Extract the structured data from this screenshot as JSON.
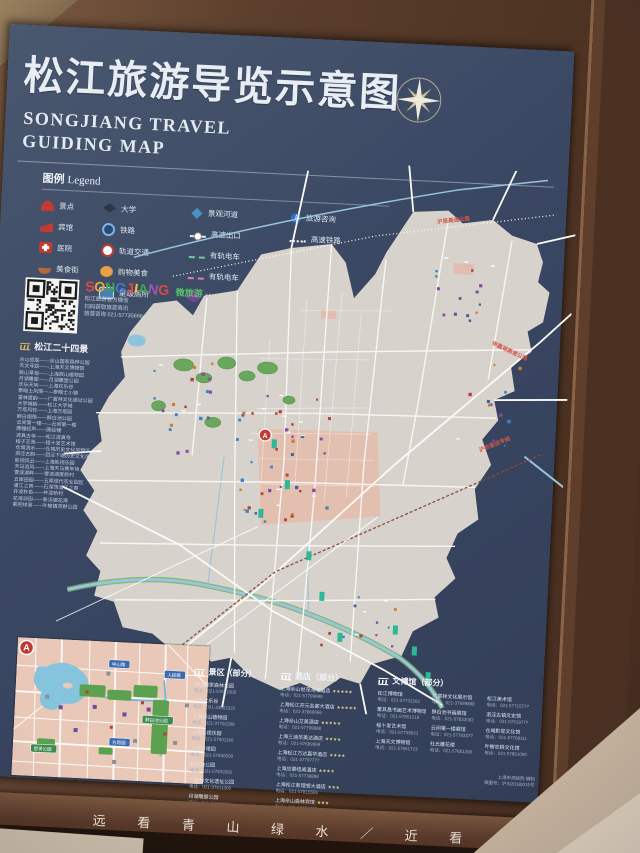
{
  "title": {
    "cn": "松江旅游导览示意图",
    "en_line1": "SONGJIANG TRAVEL",
    "en_line2": "GUIDING MAP"
  },
  "legend": {
    "heading_cn": "图例",
    "heading_en": "Legend",
    "columns": [
      {
        "items": [
          {
            "icon": "scenic",
            "label": "景点"
          },
          {
            "icon": "hotel",
            "label": "宾馆"
          },
          {
            "icon": "hospital",
            "label": "医院"
          },
          {
            "icon": "food",
            "label": "美食街"
          },
          {
            "icon": "greenway",
            "label": "绿道"
          }
        ]
      },
      {
        "items": [
          {
            "icon": "university",
            "label": "大学"
          },
          {
            "icon": "railway",
            "label": "铁路"
          },
          {
            "icon": "metro",
            "label": "轨道交通"
          },
          {
            "icon": "shopping",
            "label": "购物美食"
          },
          {
            "icon": "toilet",
            "label": "星级厕所"
          }
        ]
      },
      {
        "items": [
          {
            "icon": "river",
            "label": "景观河道"
          },
          {
            "icon": "exit",
            "label": "高速出口"
          },
          {
            "icon": "tram-green",
            "label": "有轨电车"
          },
          {
            "icon": "tram-pink",
            "label": "有轨电车"
          },
          {
            "icon": "culture",
            "label": "旅游文创"
          }
        ]
      },
      {
        "items": [
          {
            "icon": "info",
            "label": "旅游咨询"
          },
          {
            "icon": "hsr",
            "label": "高速铁路"
          }
        ]
      }
    ]
  },
  "qr": {
    "logo": "SONGJIANG",
    "logo_colors": [
      "#e2483d",
      "#f0a32f",
      "#3fa457",
      "#3a7bd5",
      "#e2483d",
      "#f0c03f",
      "#3fa457",
      "#9b59b6",
      "#e2483d"
    ],
    "logo_suffix": "微旅游",
    "lines": [
      "松江旅游官方微信",
      "扫码获取旅游资讯",
      "旅游咨询 021-57735666"
    ]
  },
  "attractions": {
    "heading": "松江二十四景",
    "items": [
      "佘山揽胜——佘山国家森林公园",
      "天文寻踪——上海天文博物馆",
      "辰山草甸——上海辰山植物园",
      "月湖雕塑——月湖雕塑公园",
      "欢乐天地——上海欢乐谷",
      "泰晤士风情——泰晤士小镇",
      "富林遗韵——广富林文化遗址公园",
      "大学城韵——松江大学城",
      "方塔风铃——上海方塔园",
      "醉白烟雨——醉白池公园",
      "云间第一楼——云间第一楼",
      "唐幢经声——唐经幢",
      "清真古寺——松江清真寺",
      "程子艺苑——程十发艺术馆",
      "仓城流水——仓城历史文化风貌区",
      "泗泾古韵——泗泾下塘历史文化风貌区",
      "影视风云——上海影视乐园",
      "天马追风——上海天马赛车场",
      "雪浪湖畔——雪浪湖度假村",
      "五厍田园——五厍现代农业园区",
      "浦江之首——石湖荡浦江之首",
      "井凌秋色——井凌桥村",
      "花海泖田——新浜镇花海",
      "氧吧绿意——叶榭镇郊野公园"
    ]
  },
  "map": {
    "edge_labels": [
      {
        "text": "沪昆高速公路"
      },
      {
        "text": "申嘉湖高速公路"
      },
      {
        "text": "沪杭客运专线"
      }
    ],
    "inset_marker": "A",
    "colors": {
      "water": "#3c4a66",
      "land": "#d7d3cc",
      "park": "#69a85c",
      "river": "#9cc4da",
      "highlight_zone": "#e3bfb0",
      "marker_red": "#bf3a30"
    }
  },
  "inset": {
    "marker": "A",
    "banners": [
      {
        "color": "#3a6ab0",
        "text": "中山路"
      },
      {
        "color": "#3a6ab0",
        "text": "人民路"
      },
      {
        "color": "#3d8a4f",
        "text": "醉白池公园"
      },
      {
        "color": "#3a6ab0",
        "text": "方塔园"
      },
      {
        "color": "#3d8a4f",
        "text": "思贤公园"
      }
    ]
  },
  "lists": {
    "scenic": {
      "heading": "景区（部分）",
      "entries": [
        {
          "name": "佘山国家森林公园",
          "phone": "电话：021-57651000"
        },
        {
          "name": "上海欢乐谷",
          "phone": "电话：021-33552222"
        },
        {
          "name": "上海辰山植物园",
          "phone": "电话：021-37792288"
        },
        {
          "name": "上海影视乐园",
          "phone": "电话：021-57601166"
        },
        {
          "name": "上海方塔园",
          "phone": "电话：021-57830509"
        },
        {
          "name": "醉白池公园",
          "phone": "电话：021-57832092"
        },
        {
          "name": "广富林文化遗址公园",
          "phone": "电话：021-37611000"
        },
        {
          "name": "月湖雕塑公园",
          "phone": "电话：021-57790900"
        },
        {
          "name": "泰晤士小镇",
          "phone": "电话：021-57768111"
        },
        {
          "name": "上海天马赛车场",
          "phone": "电话：021-57668000"
        }
      ]
    },
    "hotel": {
      "heading": "酒店（部分）",
      "entries": [
        {
          "name": "上海佘山世茂洲际酒店",
          "stars": "★★★★★",
          "phone": "电话：021-57799999"
        },
        {
          "name": "上海松江开元名都大酒店",
          "stars": "★★★★★",
          "phone": "电话：021-37866666"
        },
        {
          "name": "上海佘山艾美酒店",
          "stars": "★★★★★",
          "phone": "电话：021-57799888"
        },
        {
          "name": "上海三迪华美达酒店",
          "stars": "★★★★",
          "phone": "电话：021-67689999"
        },
        {
          "name": "上海松江万达嘉华酒店",
          "stars": "★★★★",
          "phone": "电话：021-37797777"
        },
        {
          "name": "上海应豪纽威酒店",
          "stars": "★★★★",
          "phone": "电话：021-57738888"
        },
        {
          "name": "上海松江新理想大酒店",
          "stars": "★★★",
          "phone": "电话：021-57815555"
        },
        {
          "name": "上海佘山森林宾馆",
          "stars": "★★★",
          "phone": "电话：021-57651088"
        },
        {
          "name": "上海斯波特大酒店",
          "stars": "★★★",
          "phone": "电话：021-57720000"
        }
      ]
    },
    "museum": {
      "heading": "文博馆（部分）",
      "entries": [
        {
          "name": "松江博物馆",
          "phone": "电话：021-57732262"
        },
        {
          "name": "董其昌书画艺术博物馆",
          "phone": "电话：021-57851218"
        },
        {
          "name": "程十发艺术馆",
          "phone": "电话：021-67739921"
        },
        {
          "name": "上海天文博物馆",
          "phone": "电话：021-57651723"
        },
        {
          "name": "广富林文化展示馆",
          "phone": "电话：021-37699888"
        },
        {
          "name": "醉白池书画展馆",
          "phone": "电话：021-57832092"
        },
        {
          "name": "云间第一楼展馆",
          "phone": "电话：021-57783377"
        },
        {
          "name": "杜氏雕花楼",
          "phone": "电话：021-57601290"
        },
        {
          "name": "松江美术馆",
          "phone": "电话：021-57715777"
        },
        {
          "name": "泗泾古镇文史馆",
          "phone": "电话：021-57619777"
        },
        {
          "name": "仓城影视文化馆",
          "phone": "电话：021-67768111"
        },
        {
          "name": "叶榭农耕文化馆",
          "phone": "电话：021-57861000"
        }
      ]
    }
  },
  "imprint": {
    "lines": [
      "上海市测绘院 编制",
      "审图号：沪S(2018)015号"
    ]
  },
  "banner": {
    "text": "远 看 青 山 绿 水 ／ 近 看"
  }
}
